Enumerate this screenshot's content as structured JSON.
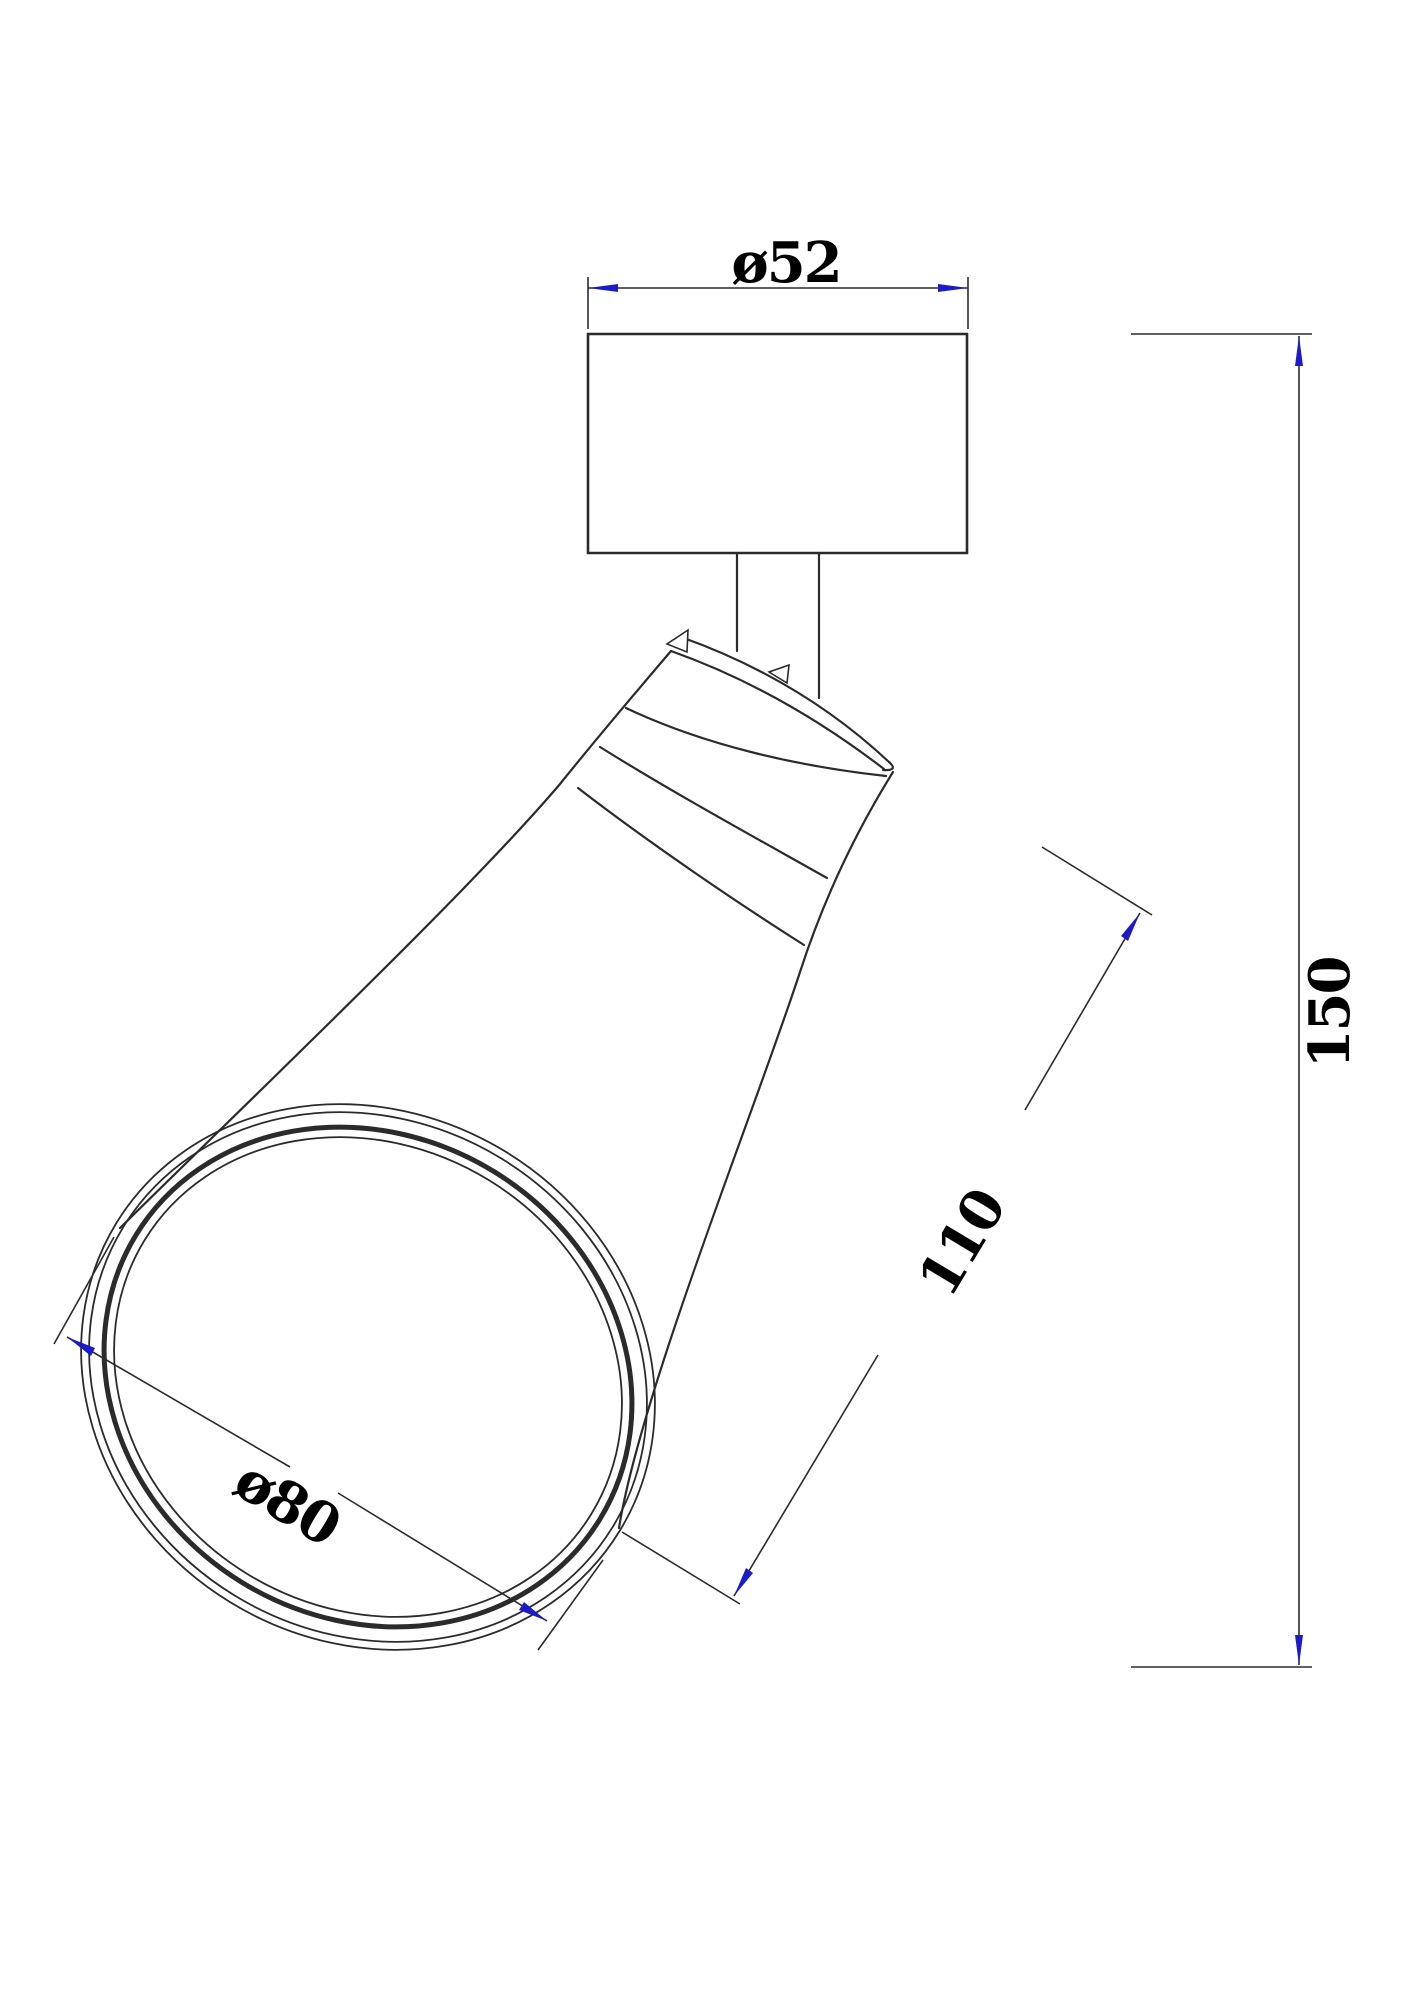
{
  "drawing": {
    "type": "technical-dimension-drawing",
    "labels": {
      "mount_diameter": "ø52",
      "overall_height": "150",
      "shade_length": "110",
      "opening_diameter": "ø80"
    },
    "values": {
      "mount_diameter": 52,
      "overall_height": 150,
      "shade_length": 110,
      "opening_diameter": 80
    },
    "colors": {
      "line": "#2b2b2b",
      "arrow": "#1b1bc8",
      "text": "#000000",
      "background": "#ffffff"
    }
  }
}
